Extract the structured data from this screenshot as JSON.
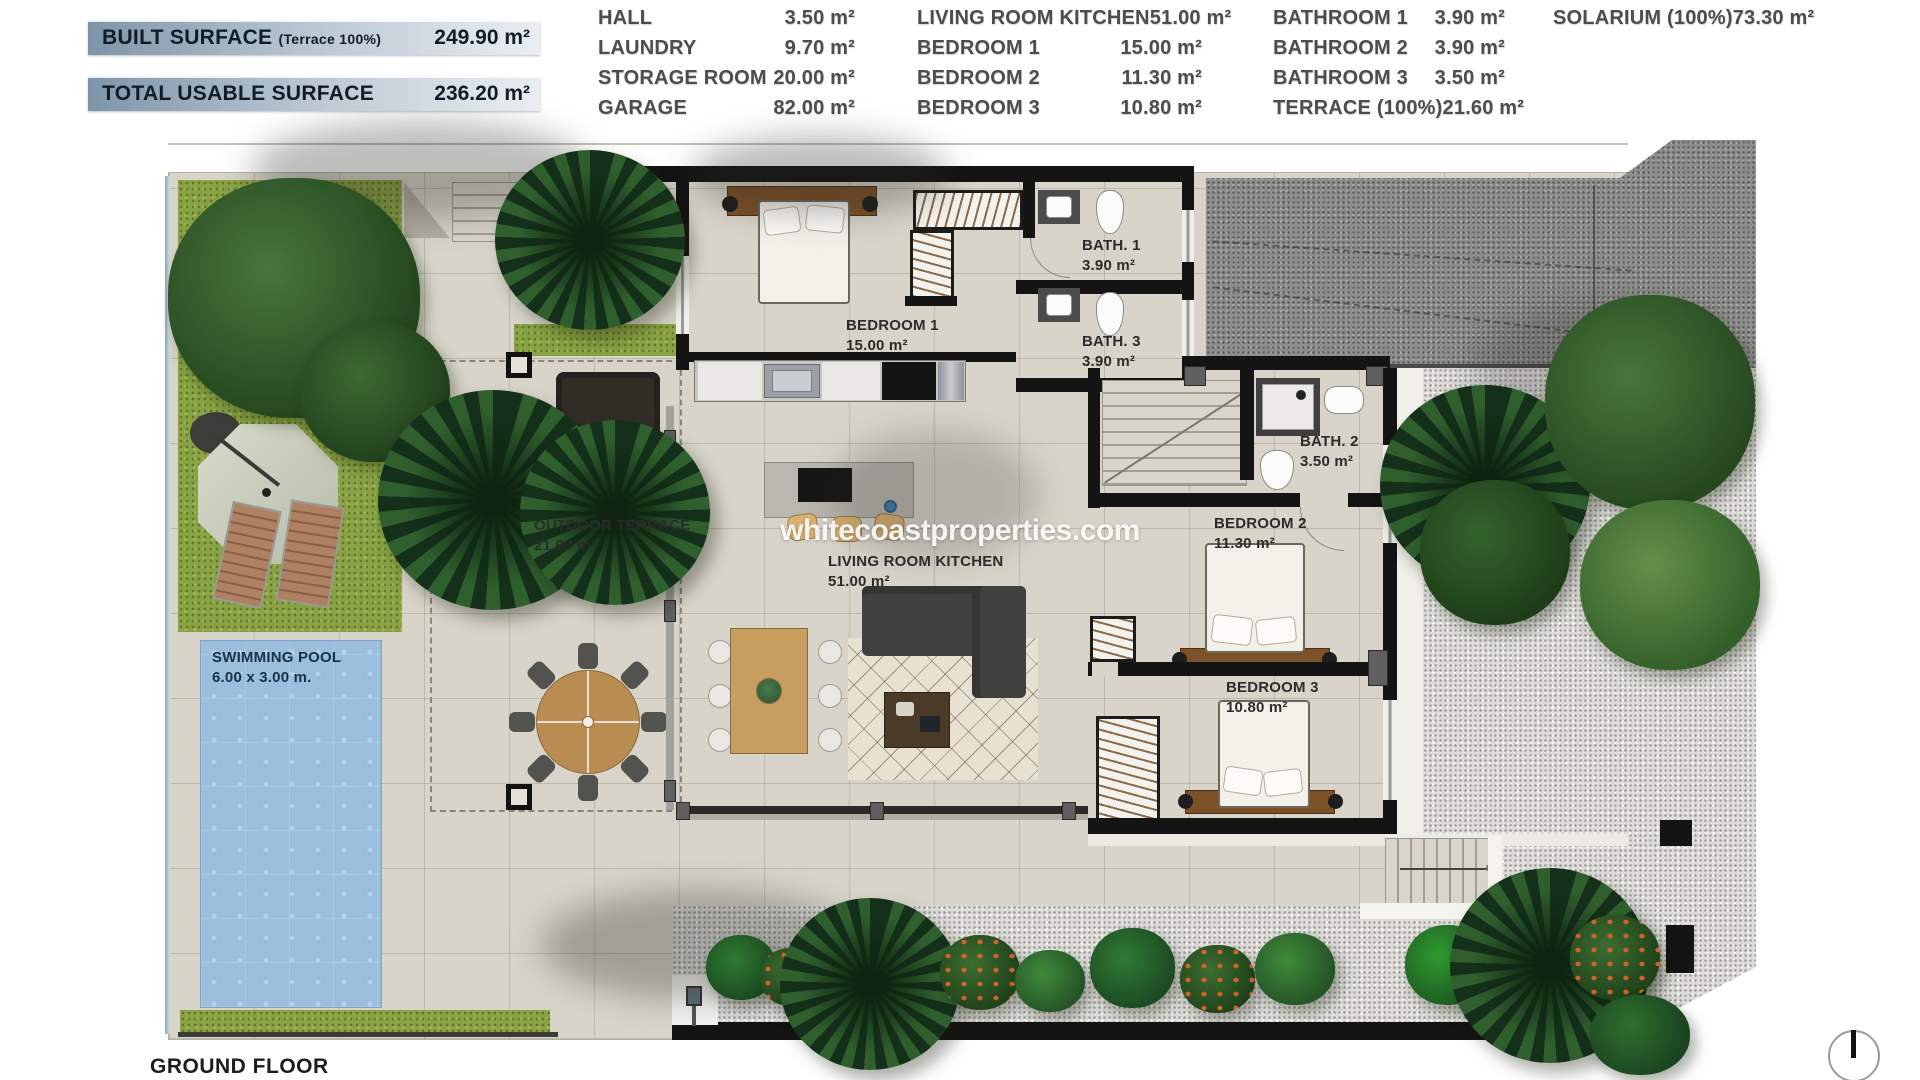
{
  "header": {
    "banners": [
      {
        "label": "BUILT SURFACE",
        "sublabel": "(Terrace 100%)",
        "value": "249.90 m²"
      },
      {
        "label": "TOTAL USABLE SURFACE",
        "sublabel": "",
        "value": "236.20 m²"
      }
    ],
    "table": {
      "columns": [
        {
          "rows": [
            {
              "name": "HALL",
              "value": "3.50 m²"
            },
            {
              "name": "LAUNDRY",
              "value": "9.70 m²"
            },
            {
              "name": "STORAGE ROOM",
              "value": "20.00 m²"
            },
            {
              "name": "GARAGE",
              "value": "82.00 m²"
            }
          ]
        },
        {
          "rows": [
            {
              "name": "LIVING ROOM KITCHEN",
              "value": "51.00 m²"
            },
            {
              "name": "BEDROOM 1",
              "value": "15.00 m²"
            },
            {
              "name": "BEDROOM 2",
              "value": "11.30 m²"
            },
            {
              "name": "BEDROOM 3",
              "value": "10.80 m²"
            }
          ]
        },
        {
          "rows": [
            {
              "name": "BATHROOM 1",
              "value": "3.90 m²"
            },
            {
              "name": "BATHROOM 2",
              "value": "3.90 m²"
            },
            {
              "name": "BATHROOM 3",
              "value": "3.50 m²"
            },
            {
              "name": "TERRACE (100%)",
              "value": "21.60 m²"
            }
          ]
        },
        {
          "rows": [
            {
              "name": "SOLARIUM (100%)",
              "value": "73.30 m²"
            }
          ]
        }
      ]
    }
  },
  "plan": {
    "labels": {
      "bedroom1": {
        "name": "BEDROOM 1",
        "area": "15.00 m²"
      },
      "bath1": {
        "name": "BATH. 1",
        "area": "3.90 m²"
      },
      "bath3": {
        "name": "BATH. 3",
        "area": "3.90 m²"
      },
      "bath2": {
        "name": "BATH. 2",
        "area": "3.50 m²"
      },
      "bedroom2": {
        "name": "BEDROOM 2",
        "area": "11.30 m²"
      },
      "bedroom3": {
        "name": "BEDROOM 3",
        "area": "10.80 m²"
      },
      "living": {
        "name": "LIVING ROOM KITCHEN",
        "area": "51.00 m²"
      },
      "outdoor_terrace": {
        "name": "OUTDOOR TERRACE",
        "area": "21.60 m²"
      },
      "swimming_pool": {
        "name": "SWIMMING POOL",
        "area": "6.00 x 3.00 m."
      }
    },
    "watermark": "whitecoastproperties.com",
    "floor_title": "GROUND FLOOR"
  },
  "colors": {
    "banner_accent": "#7e95a9",
    "grass": "#8aa344",
    "pool": "#9cbedd",
    "driveway": "#8d8d8b",
    "gravel": "#dddcd8",
    "wall": "#141414",
    "wood": "#7c5128"
  }
}
